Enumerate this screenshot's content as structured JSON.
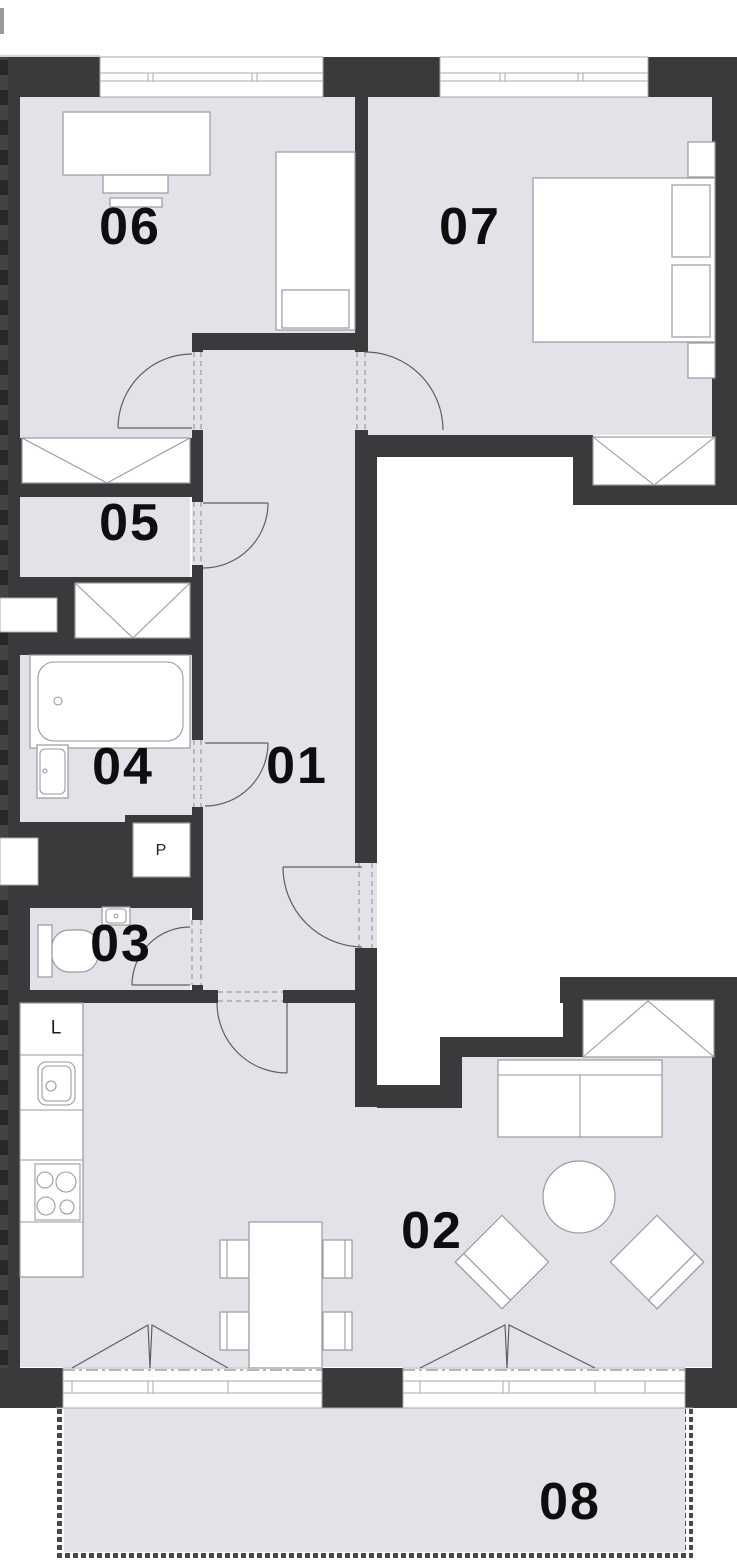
{
  "rooms": [
    {
      "label": "01"
    },
    {
      "label": "02"
    },
    {
      "label": "03"
    },
    {
      "label": "04"
    },
    {
      "label": "05"
    },
    {
      "label": "06"
    },
    {
      "label": "07"
    },
    {
      "label": "08"
    }
  ],
  "appliances": [
    {
      "label": "P"
    },
    {
      "label": "L"
    }
  ],
  "colors": {
    "wall": "#3a3a3c",
    "wall-dark": "#262628",
    "floor": "#e3e2e8",
    "line": "#9a9aa0",
    "door": "#5f5f63",
    "label": "#0e0e0e",
    "bg": "#ffffff"
  }
}
